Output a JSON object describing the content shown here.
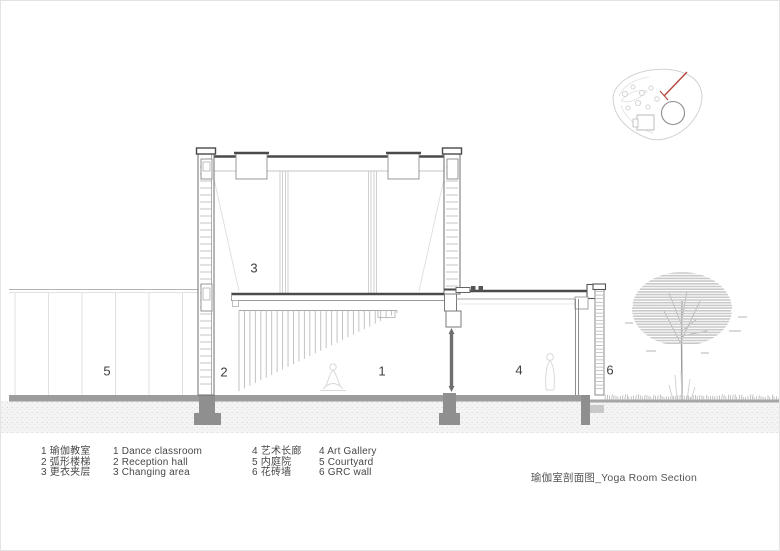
{
  "drawing": {
    "markers": {
      "dance_classroom": "1",
      "reception_hall": "2",
      "changing_area": "3",
      "art_gallery": "4",
      "courtyard": "5",
      "grc_wall": "6"
    },
    "key_plan": {
      "section_arrow_color": "#b5453c"
    }
  },
  "legend": {
    "left": {
      "zh": [
        "1 瑜伽教室",
        "2 弧形楼梯",
        "3 更衣夹层"
      ],
      "en": [
        "1 Dance classroom",
        "2 Reception hall",
        "3 Changing area"
      ]
    },
    "right": {
      "zh": [
        "4 艺术长廊",
        "5 内庭院",
        "6 花砖墙"
      ],
      "en": [
        "4 Art Gallery",
        "5 Courtyard",
        "6 GRC wall"
      ]
    }
  },
  "title_block": {
    "caption": "瑜伽室剖面图_Yoga Room Section"
  },
  "colors": {
    "section_cut": "#4a4a4a",
    "medium_line": "#8a8a8a",
    "light_line": "#c8c8c8",
    "ground_fill": "#9b9b9b",
    "footing_fill": "#8f8f8f",
    "accent_red": "#b5453c",
    "text": "#474747"
  }
}
